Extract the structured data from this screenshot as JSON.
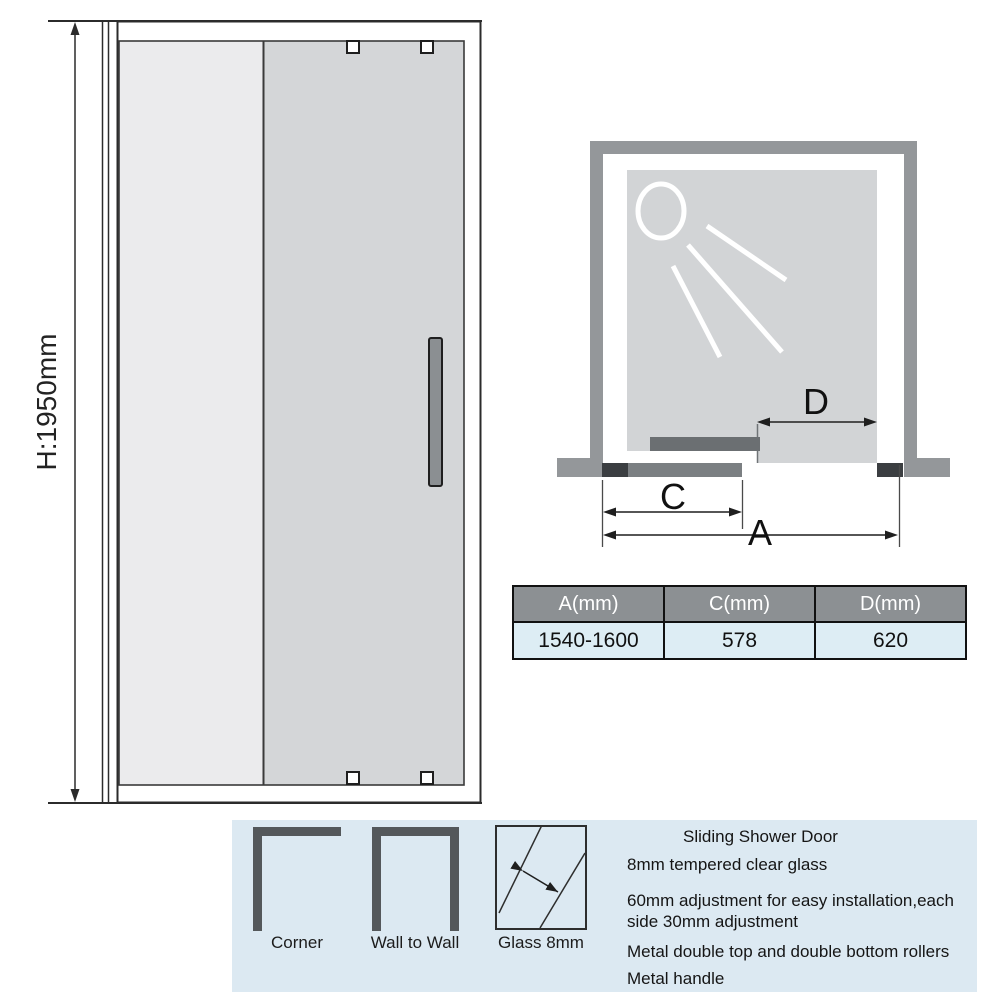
{
  "front_view": {
    "height_label": "H:1950mm"
  },
  "top_view": {
    "label_d": "D",
    "label_c": "C",
    "label_a": "A"
  },
  "spec_table": {
    "headers": [
      "A(mm)",
      "C(mm)",
      "D(mm)"
    ],
    "values": [
      "1540-1600",
      "578",
      "620"
    ]
  },
  "footer": {
    "config_icons": [
      {
        "label": "Corner"
      },
      {
        "label": "Wall to Wall"
      },
      {
        "label": "Glass 8mm"
      }
    ],
    "features": {
      "title": "Sliding Shower Door",
      "lines": [
        "8mm tempered clear glass",
        "60mm adjustment for easy installation,each",
        "side 30mm adjustment",
        "Metal double top and double bottom rollers",
        "Metal handle"
      ]
    }
  },
  "colors": {
    "table_header_bg": "#8c9093",
    "table_row_bg": "#ddedf4",
    "footer_panel_bg": "#dce9f2",
    "wall_gray": "#94979a",
    "fixed_glass": "#ebebed",
    "sliding_glass": "#d4d6d8",
    "door_bar": "#6b6f72",
    "track_dark_cap": "#3b3e41"
  }
}
